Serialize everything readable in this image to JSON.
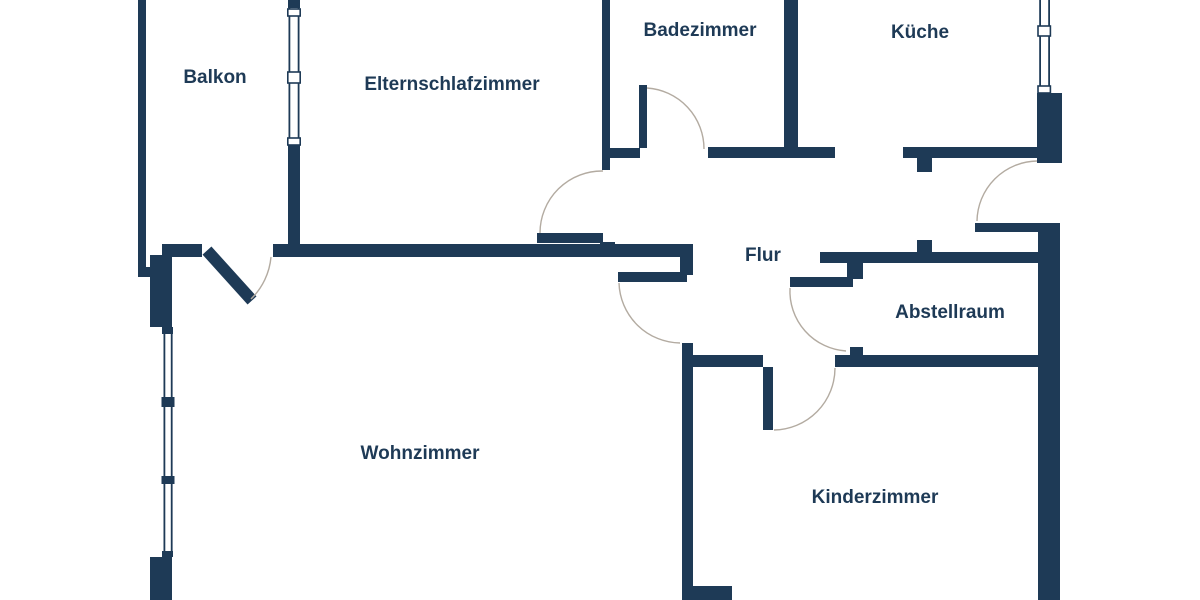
{
  "rooms": [
    {
      "id": "balkon",
      "label": "Balkon"
    },
    {
      "id": "elternschlafzimmer",
      "label": "Elternschlafzimmer"
    },
    {
      "id": "badezimmer",
      "label": "Badezimmer"
    },
    {
      "id": "kueche",
      "label": "Küche"
    },
    {
      "id": "flur",
      "label": "Flur"
    },
    {
      "id": "abstellraum",
      "label": "Abstellraum"
    },
    {
      "id": "wohnzimmer",
      "label": "Wohnzimmer"
    },
    {
      "id": "kinderzimmer",
      "label": "Kinderzimmer"
    }
  ],
  "colors": {
    "wall": "#1e3a56",
    "background": "#ffffff",
    "door_arc": "#b3aba1",
    "label_text": "#1e3a56"
  }
}
